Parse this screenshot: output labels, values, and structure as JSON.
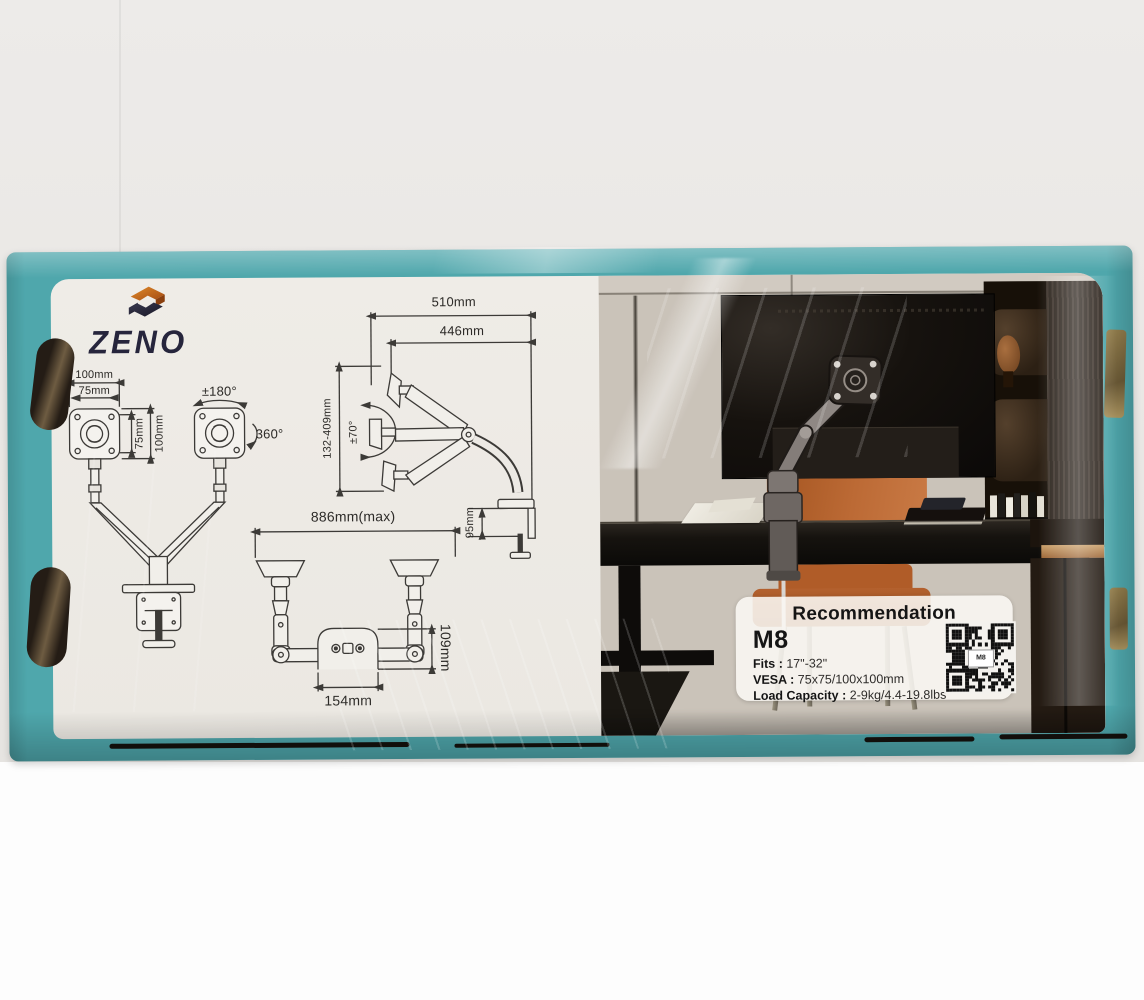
{
  "brand": {
    "name": "ZENO"
  },
  "colors": {
    "box_teal": "#4fa7ac",
    "logo_navy": "#26253c",
    "logo_orange": "#c4671d",
    "chair_leather": "#b4612e"
  },
  "diagrams": {
    "front": {
      "labels": {
        "top_width": "100mm",
        "inner_width": "75mm",
        "side_height": "75mm",
        "side_height_outer": "100mm",
        "swivel": "±180°",
        "rotation": "360°"
      }
    },
    "side": {
      "labels": {
        "full_reach": "510mm",
        "arm_reach": "446mm",
        "height_range": "132-409mm",
        "tilt": "±70°",
        "clamp_height": "95mm"
      }
    },
    "top": {
      "labels": {
        "max_span": "886mm(max)",
        "base_depth": "109mm",
        "base_width": "154mm"
      }
    }
  },
  "card": {
    "title": "Recommendation",
    "model": "M8",
    "specs": [
      {
        "label": "Fits :",
        "value": "17\"-32\""
      },
      {
        "label": "VESA :",
        "value": "75x75/100x100mm"
      },
      {
        "label": "Load Capacity :",
        "value": "2-9kg/4.4-19.8lbs"
      }
    ],
    "qr_label": "M8"
  }
}
